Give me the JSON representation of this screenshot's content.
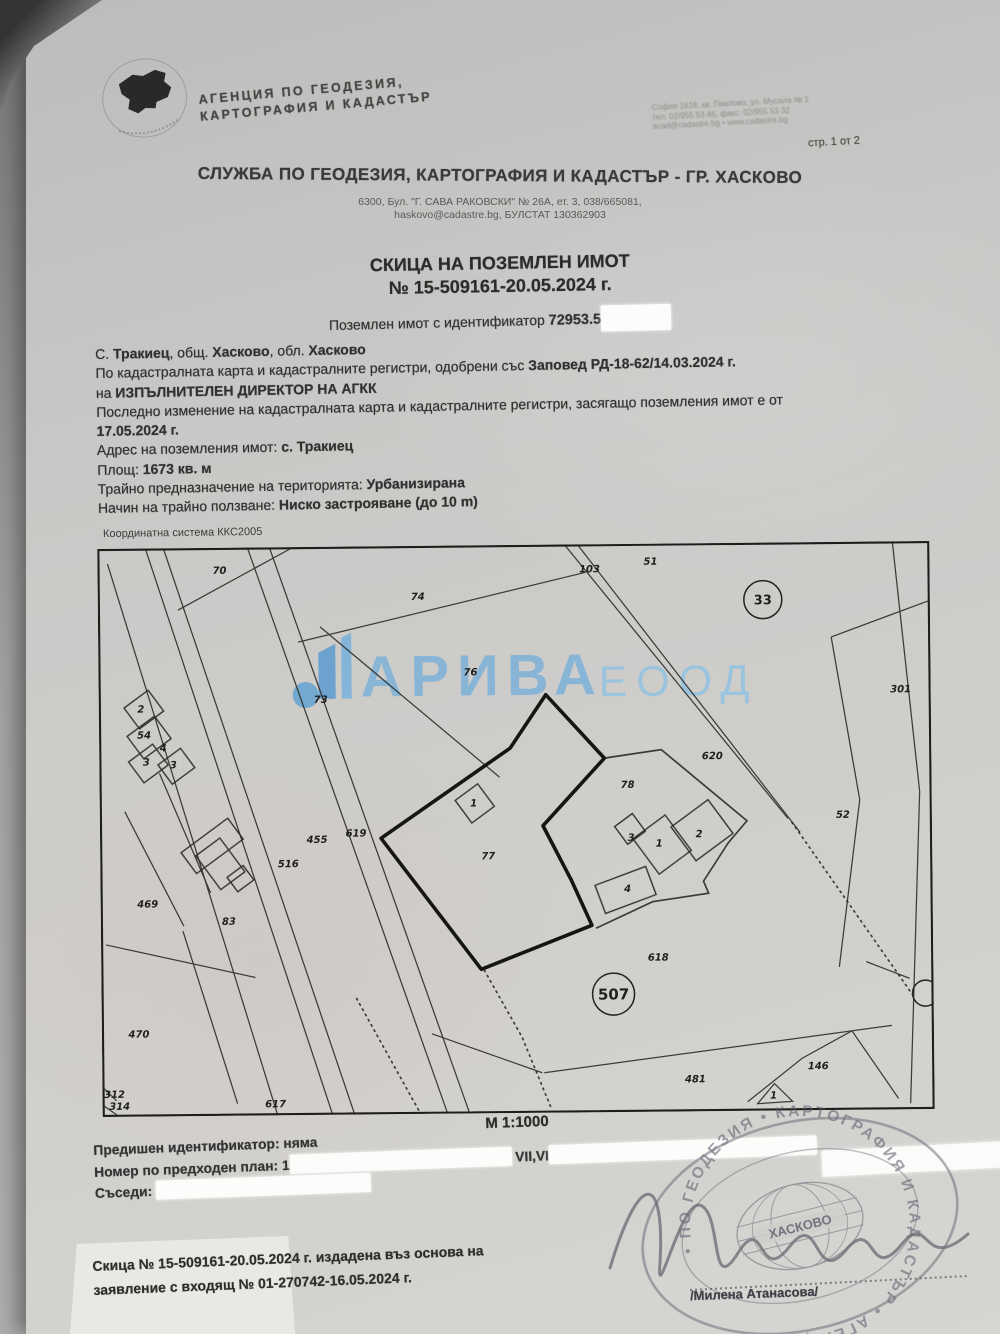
{
  "page_note": "стр. 1 от 2",
  "agency": {
    "name_line1": "АГЕНЦИЯ ПО ГЕОДЕЗИЯ,",
    "name_line2": "КАРТОГРАФИЯ И КАДАСТЪР",
    "hq_lines": [
      "София 1618, кв. Павлово, ул. Мусала № 1",
      "тел: 02/955 53 46, факс: 02/955 53 32",
      "acad@cadastre.bg • www.cadastre.bg"
    ]
  },
  "office": {
    "title": "СЛУЖБА ПО ГЕОДЕЗИЯ, КАРТОГРАФИЯ И КАДАСТЪР - ГР. ХАСКОВО",
    "address": "6300, Бул. \"Г. САВА РАКОВСКИ\" № 26А, ет. 3, 038/665081,",
    "contact": "haskovo@cadastre.bg, БУЛСТАТ 130362903"
  },
  "doc_title": {
    "line1": "СКИЦА НА ПОЗЕМЛЕН ИМОТ",
    "line2": "№ 15-509161-20.05.2024 г."
  },
  "identifier": {
    "label": "Поземлен имот с  идентификатор",
    "value": "72953.5"
  },
  "details": [
    [
      {
        "t": "С. ",
        "b": 0
      },
      {
        "t": "Тракиец",
        "b": 1
      },
      {
        "t": ", общ. ",
        "b": 0
      },
      {
        "t": "Хасково",
        "b": 1
      },
      {
        "t": ", обл. ",
        "b": 0
      },
      {
        "t": "Хасково",
        "b": 1
      }
    ],
    [
      {
        "t": "По кадастралната карта и кадастралните регистри, одобрени със ",
        "b": 0
      },
      {
        "t": "Заповед РД-18-62/14.03.2024 г.",
        "b": 1
      }
    ],
    [
      {
        "t": "на ",
        "b": 0
      },
      {
        "t": "ИЗПЪЛНИТЕЛЕН ДИРЕКТОР НА АГКК",
        "b": 1
      }
    ],
    [
      {
        "t": "Последно изменение на кадастралната карта и кадастралните регистри, засягащо поземления имот е от",
        "b": 0
      }
    ],
    [
      {
        "t": "17.05.2024 г.",
        "b": 1
      }
    ],
    [
      {
        "t": "Адрес на поземления имот: ",
        "b": 0
      },
      {
        "t": "с. Тракиец",
        "b": 1
      }
    ],
    [
      {
        "t": "Площ: ",
        "b": 0
      },
      {
        "t": "1673 кв. м",
        "b": 1
      }
    ],
    [
      {
        "t": "Трайно предназначение на територията: ",
        "b": 0
      },
      {
        "t": "Урбанизирана",
        "b": 1
      }
    ],
    [
      {
        "t": "Начин на трайно ползване: ",
        "b": 0
      },
      {
        "t": "Ниско застрояване (до 10 m)",
        "b": 1
      }
    ]
  ],
  "map": {
    "coord_system": "Координатна система ККС2005",
    "scale": "М 1:1000",
    "watermark": {
      "name": "АРИВА",
      "suffix": "ЕООД",
      "color1": "#7db1d9",
      "color2": "#92c2e2",
      "logo_color": "#66a3d2"
    },
    "labels": [
      {
        "t": "70",
        "x": 122,
        "y": 26
      },
      {
        "t": "74",
        "x": 320,
        "y": 54
      },
      {
        "t": "51",
        "x": 553,
        "y": 21
      },
      {
        "t": "103",
        "x": 492,
        "y": 28,
        "s": 9
      },
      {
        "t": "73",
        "x": 222,
        "y": 156
      },
      {
        "t": "76",
        "x": 372,
        "y": 130
      },
      {
        "t": "301",
        "x": 802,
        "y": 151,
        "s": 8.5
      },
      {
        "t": "620",
        "x": 613,
        "y": 216
      },
      {
        "t": "52",
        "x": 743,
        "y": 276
      },
      {
        "t": "78",
        "x": 528,
        "y": 244
      },
      {
        "t": "77",
        "x": 388,
        "y": 314,
        "s": 12
      },
      {
        "t": "455",
        "x": 217,
        "y": 296
      },
      {
        "t": "619",
        "x": 256,
        "y": 290
      },
      {
        "t": "516",
        "x": 188,
        "y": 320
      },
      {
        "t": "469",
        "x": 47,
        "y": 359
      },
      {
        "t": "83",
        "x": 128,
        "y": 377
      },
      {
        "t": "470",
        "x": 37,
        "y": 489
      },
      {
        "t": "617",
        "x": 173,
        "y": 560
      },
      {
        "t": "618",
        "x": 557,
        "y": 417
      },
      {
        "t": "481",
        "x": 593,
        "y": 539
      },
      {
        "t": "146",
        "x": 716,
        "y": 527
      },
      {
        "t": "2",
        "x": 42,
        "y": 164,
        "s": 8
      },
      {
        "t": "54",
        "x": 45,
        "y": 190,
        "s": 8
      },
      {
        "t": "3",
        "x": 47,
        "y": 217,
        "s": 8
      },
      {
        "t": "3",
        "x": 74,
        "y": 220,
        "s": 8
      },
      {
        "t": "4",
        "x": 64,
        "y": 203,
        "s": 7
      },
      {
        "t": "1",
        "x": 374,
        "y": 261,
        "s": 8
      },
      {
        "t": "3",
        "x": 531,
        "y": 297,
        "s": 8
      },
      {
        "t": "1",
        "x": 559,
        "y": 303,
        "s": 8
      },
      {
        "t": "2",
        "x": 599,
        "y": 294,
        "s": 8
      },
      {
        "t": "4",
        "x": 527,
        "y": 348,
        "s": 8
      },
      {
        "t": "1",
        "x": 671,
        "y": 556,
        "s": 7
      },
      {
        "t": "312",
        "x": 12,
        "y": 549,
        "s": 6.5
      },
      {
        "t": "314",
        "x": 17,
        "y": 561,
        "s": 6.5
      }
    ],
    "circled": [
      {
        "t": "33",
        "x": 665,
        "y": 57,
        "r": 19,
        "fs": 13
      },
      {
        "t": "507",
        "x": 512,
        "y": 450,
        "r": 21,
        "fs": 15
      },
      {
        "t": "",
        "x": 824,
        "y": 452,
        "r": 13,
        "fs": 10
      }
    ]
  },
  "footer": {
    "lines": [
      [
        {
          "t": "Предишен идентификатор: няма",
          "b": 0
        }
      ],
      [
        {
          "t": "Номер по предходен план: 1",
          "b": 0
        },
        {
          "r": 222
        },
        {
          "t": " VII,VI",
          "b": 0
        },
        {
          "r": 268
        }
      ],
      [
        {
          "t": "Съседи: ",
          "b": 0
        },
        {
          "r": 215
        }
      ]
    ],
    "issue_line1": "Скица № 15-509161-20.05.2024 г. издадена въз основа на",
    "issue_line2": "заявление с входящ № 01-270742-16.05.2024 г.",
    "signature_name": "/Милена Атанасова/",
    "stamp_ring_text": "• ПО ГЕОДЕЗИЯ • КАРТОГРАФИЯ И КАДАСТЪР • АГЕНЦИЯ ",
    "stamp_center_text": "ХАСКОВО"
  }
}
